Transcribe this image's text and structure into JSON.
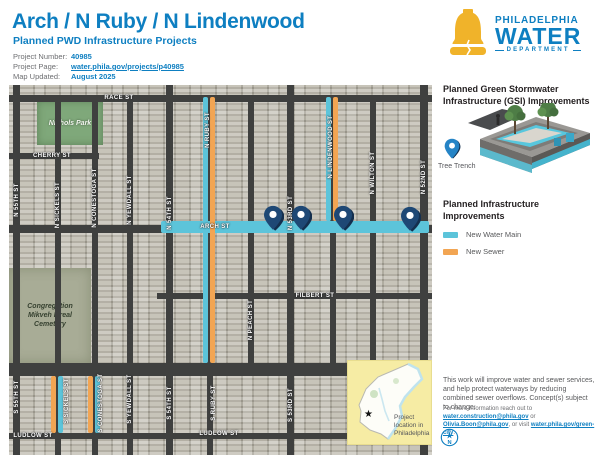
{
  "colors": {
    "brand_blue": "#0E7FC1",
    "brand_yellow": "#F0B32A",
    "water": "#5CC4DA",
    "sewer": "#F2A553",
    "pin_navy": "#1E4875",
    "pin_shadow": "#142F4E",
    "pin_blue": "#2584C6"
  },
  "header": {
    "title": "Arch / N Ruby / N Lindenwood",
    "subtitle": "Planned PWD Infrastructure Projects",
    "info": [
      {
        "label": "Project Number:",
        "value": "40985"
      },
      {
        "label": "Project Page:",
        "value": "water.phila.gov/projects/p40985"
      },
      {
        "label": "Map Updated:",
        "value": "August 2025"
      }
    ],
    "logo": {
      "top": "PHILADELPHIA",
      "main": "WATER",
      "bottom": "DEPARTMENT"
    }
  },
  "map": {
    "park_label": "Nichols Park",
    "cemetery_label": "Congregation\nMikveh Isreal\nCemetery",
    "inset_caption": "Project location in Philadelphia",
    "inset_star": "★",
    "roads": [
      {
        "x": 0,
        "y": 10,
        "w": 423,
        "h": 7
      },
      {
        "x": 0,
        "y": 68,
        "w": 90,
        "h": 6
      },
      {
        "x": 0,
        "y": 140,
        "w": 423,
        "h": 8
      },
      {
        "x": 148,
        "y": 208,
        "w": 275,
        "h": 6
      },
      {
        "x": 0,
        "y": 278,
        "w": 423,
        "h": 13
      },
      {
        "x": 0,
        "y": 348,
        "w": 423,
        "h": 6
      },
      {
        "x": 4,
        "y": 0,
        "w": 7,
        "h": 370
      },
      {
        "x": 46,
        "y": 10,
        "w": 6,
        "h": 360
      },
      {
        "x": 83,
        "y": 10,
        "w": 6,
        "h": 360
      },
      {
        "x": 118,
        "y": 10,
        "w": 6,
        "h": 360
      },
      {
        "x": 157,
        "y": 0,
        "w": 7,
        "h": 370
      },
      {
        "x": 198,
        "y": 10,
        "w": 6,
        "h": 360
      },
      {
        "x": 239,
        "y": 10,
        "w": 6,
        "h": 281
      },
      {
        "x": 278,
        "y": 0,
        "w": 7,
        "h": 370
      },
      {
        "x": 321,
        "y": 10,
        "w": 6,
        "h": 281
      },
      {
        "x": 361,
        "y": 10,
        "w": 6,
        "h": 281
      },
      {
        "x": 411,
        "y": 0,
        "w": 8,
        "h": 370
      }
    ],
    "lines": [
      {
        "kind": "water",
        "x": 152,
        "y": 136,
        "w": 268,
        "h": 12
      },
      {
        "kind": "water",
        "x": 194,
        "y": 12,
        "w": 5,
        "h": 266
      },
      {
        "kind": "sewer",
        "x": 201,
        "y": 12,
        "w": 5,
        "h": 266
      },
      {
        "kind": "water",
        "x": 317,
        "y": 12,
        "w": 5,
        "h": 124
      },
      {
        "kind": "sewer",
        "x": 324,
        "y": 12,
        "w": 5,
        "h": 124
      },
      {
        "kind": "sewer",
        "x": 42,
        "y": 291,
        "w": 5,
        "h": 57
      },
      {
        "kind": "water",
        "x": 49,
        "y": 291,
        "w": 5,
        "h": 57
      },
      {
        "kind": "sewer",
        "x": 79,
        "y": 291,
        "w": 5,
        "h": 57
      },
      {
        "kind": "water",
        "x": 86,
        "y": 291,
        "w": 5,
        "h": 57
      }
    ],
    "labels": [
      {
        "t": "RACE ST",
        "x": 110,
        "y": 13,
        "v": false
      },
      {
        "t": "CHERRY ST",
        "x": 43,
        "y": 71,
        "v": false
      },
      {
        "t": "ARCH ST",
        "x": 206,
        "y": 142,
        "v": false
      },
      {
        "t": "FILBERT ST",
        "x": 306,
        "y": 211,
        "v": false
      },
      {
        "t": "LUDLOW ST",
        "x": 24,
        "y": 351,
        "v": false
      },
      {
        "t": "LUDLOW ST",
        "x": 210,
        "y": 349,
        "v": false
      },
      {
        "t": "N 55TH ST",
        "x": 8,
        "y": 115,
        "v": true
      },
      {
        "t": "N SICKELS ST",
        "x": 49,
        "y": 120,
        "v": true
      },
      {
        "t": "N CONESTOGA ST",
        "x": 86,
        "y": 113,
        "v": true
      },
      {
        "t": "N YEWDALL ST",
        "x": 121,
        "y": 115,
        "v": true
      },
      {
        "t": "N 54TH ST",
        "x": 161,
        "y": 128,
        "v": true
      },
      {
        "t": "N RUBY ST",
        "x": 199,
        "y": 45,
        "v": true
      },
      {
        "t": "N PEACH ST",
        "x": 242,
        "y": 235,
        "v": true
      },
      {
        "t": "N 53RD ST",
        "x": 282,
        "y": 128,
        "v": true
      },
      {
        "t": "N LINDENWOOD ST",
        "x": 322,
        "y": 62,
        "v": true
      },
      {
        "t": "N WILTON ST",
        "x": 364,
        "y": 88,
        "v": true
      },
      {
        "t": "N 52ND ST",
        "x": 415,
        "y": 92,
        "v": true
      },
      {
        "t": "S 55TH ST",
        "x": 8,
        "y": 312,
        "v": true
      },
      {
        "t": "S SICKELS ST",
        "x": 58,
        "y": 316,
        "v": true
      },
      {
        "t": "S CONESTOGA ST",
        "x": 92,
        "y": 318,
        "v": true
      },
      {
        "t": "S YEWDALL ST",
        "x": 121,
        "y": 314,
        "v": true
      },
      {
        "t": "S 54TH ST",
        "x": 161,
        "y": 318,
        "v": true
      },
      {
        "t": "S RUBY ST",
        "x": 205,
        "y": 318,
        "v": true
      },
      {
        "t": "S 53RD ST",
        "x": 282,
        "y": 320,
        "v": true
      }
    ],
    "pins": [
      {
        "x": 264,
        "y": 146
      },
      {
        "x": 292,
        "y": 146
      },
      {
        "x": 334,
        "y": 146
      },
      {
        "x": 401,
        "y": 147
      }
    ]
  },
  "sidebar": {
    "gsi_heading": "Planned Green Stormwater Infrastructure (GSI) Improvements",
    "tree_trench_label": "Tree Trench",
    "infra_heading": "Planned Infrastructure Improvements",
    "legend": [
      {
        "kind": "water",
        "label": "New Water Main"
      },
      {
        "kind": "sewer",
        "label": "New Sewer"
      }
    ],
    "body": "This work will improve water and sewer services, and help protect waterways by reducing combined sewer overflows. Concept(s) subject to change.",
    "contact": {
      "prefix": "For more information reach out to ",
      "email1": "water.construction@phila.gov",
      "mid1": " or ",
      "email2": "Olivia.Boon@phila.gov",
      "mid2": ", or visit ",
      "link": "water.phila.gov/green-city",
      "suffix": "."
    },
    "compass_label": "N"
  }
}
